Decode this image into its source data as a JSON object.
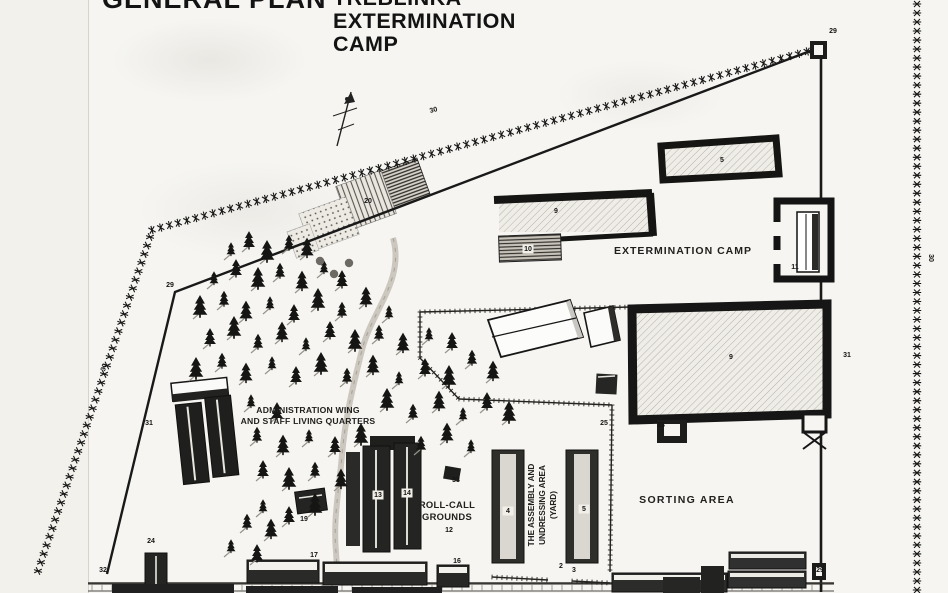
{
  "page": {
    "paper_color": "#f6f5f1",
    "ink_color": "#1a1a1a"
  },
  "titles": {
    "plan": "GENERAL PLAN",
    "camp_line1": "TREBLINKA",
    "camp_line2": "EXTERMINATION",
    "camp_line3": "CAMP"
  },
  "area_labels": [
    {
      "text": "EXTERMINATION CAMP",
      "x": 683,
      "y": 254,
      "size": 10.5,
      "ls": 1
    },
    {
      "text": "ADMINISTRATION WING",
      "x": 308,
      "y": 413,
      "size": 8.6,
      "ls": 0.2
    },
    {
      "text": "AND STAFF LIVING QUARTERS",
      "x": 308,
      "y": 424,
      "size": 8.6,
      "ls": 0.2
    },
    {
      "text": "ROLL-CALL",
      "x": 447,
      "y": 508,
      "size": 9.4,
      "ls": 0.3
    },
    {
      "text": "GROUNDS",
      "x": 447,
      "y": 520,
      "size": 9.4,
      "ls": 0.3
    },
    {
      "text": "THE ASSEMBLY AND",
      "x": 534,
      "y": 505,
      "size": 8.2,
      "rot": -90
    },
    {
      "text": "UNDRESSING AREA",
      "x": 545,
      "y": 505,
      "size": 8.2,
      "rot": -90
    },
    {
      "text": "(YARD)",
      "x": 556,
      "y": 505,
      "size": 8.2,
      "rot": -90
    },
    {
      "text": "SORTING AREA",
      "x": 687,
      "y": 503,
      "size": 10.5,
      "ls": 1.3
    }
  ],
  "number_labels": [
    {
      "t": "29",
      "x": 833,
      "y": 33
    },
    {
      "t": "30",
      "x": 434,
      "y": 112,
      "rot": -15
    },
    {
      "t": "30",
      "x": 929,
      "y": 258,
      "rot": 90
    },
    {
      "t": "30",
      "x": 106,
      "y": 368,
      "rot": -72
    },
    {
      "t": "29",
      "x": 170,
      "y": 287
    },
    {
      "t": "31",
      "x": 149,
      "y": 425
    },
    {
      "t": "31",
      "x": 847,
      "y": 357
    },
    {
      "t": "32",
      "x": 103,
      "y": 572
    },
    {
      "t": "24",
      "x": 151,
      "y": 543
    },
    {
      "t": "19",
      "x": 304,
      "y": 521
    },
    {
      "t": "20",
      "x": 368,
      "y": 203
    },
    {
      "t": "13",
      "x": 378,
      "y": 497,
      "bg": true
    },
    {
      "t": "14",
      "x": 407,
      "y": 495,
      "bg": true
    },
    {
      "t": "12",
      "x": 449,
      "y": 532
    },
    {
      "t": "33",
      "x": 456,
      "y": 482
    },
    {
      "t": "4",
      "x": 508,
      "y": 513,
      "bg": true
    },
    {
      "t": "5",
      "x": 584,
      "y": 511,
      "bg": true
    },
    {
      "t": "9",
      "x": 556,
      "y": 213
    },
    {
      "t": "10",
      "x": 528,
      "y": 251,
      "bg": true
    },
    {
      "t": "5",
      "x": 722,
      "y": 162
    },
    {
      "t": "11",
      "x": 795,
      "y": 269
    },
    {
      "t": "25",
      "x": 604,
      "y": 425
    },
    {
      "t": "33",
      "x": 661,
      "y": 427
    },
    {
      "t": "9",
      "x": 731,
      "y": 359
    },
    {
      "t": "29",
      "x": 820,
      "y": 572
    },
    {
      "t": "2",
      "x": 561,
      "y": 568
    },
    {
      "t": "3",
      "x": 574,
      "y": 572
    },
    {
      "t": "17",
      "x": 314,
      "y": 557
    },
    {
      "t": "16",
      "x": 457,
      "y": 563
    }
  ],
  "icons": [
    "north-arrow-icon",
    "fence-barb-icon",
    "tree-icon",
    "watchtower-icon"
  ],
  "trees": [
    [
      231,
      252
    ],
    [
      249,
      244
    ],
    [
      267,
      256
    ],
    [
      289,
      246
    ],
    [
      307,
      252
    ],
    [
      214,
      281
    ],
    [
      236,
      272
    ],
    [
      258,
      283
    ],
    [
      280,
      274
    ],
    [
      302,
      285
    ],
    [
      324,
      270
    ],
    [
      342,
      283
    ],
    [
      200,
      311
    ],
    [
      224,
      302
    ],
    [
      246,
      315
    ],
    [
      270,
      306
    ],
    [
      294,
      317
    ],
    [
      318,
      304
    ],
    [
      342,
      313
    ],
    [
      366,
      301
    ],
    [
      389,
      315
    ],
    [
      210,
      341
    ],
    [
      234,
      332
    ],
    [
      258,
      345
    ],
    [
      282,
      336
    ],
    [
      306,
      347
    ],
    [
      330,
      334
    ],
    [
      355,
      345
    ],
    [
      379,
      336
    ],
    [
      403,
      347
    ],
    [
      429,
      337
    ],
    [
      452,
      345
    ],
    [
      196,
      373
    ],
    [
      222,
      364
    ],
    [
      246,
      377
    ],
    [
      272,
      366
    ],
    [
      296,
      379
    ],
    [
      321,
      368
    ],
    [
      347,
      379
    ],
    [
      373,
      369
    ],
    [
      399,
      381
    ],
    [
      425,
      371
    ],
    [
      449,
      381
    ],
    [
      472,
      361
    ],
    [
      493,
      375
    ],
    [
      251,
      404
    ],
    [
      277,
      415
    ],
    [
      387,
      404
    ],
    [
      413,
      415
    ],
    [
      439,
      405
    ],
    [
      463,
      417
    ],
    [
      487,
      405
    ],
    [
      509,
      417
    ],
    [
      257,
      438
    ],
    [
      283,
      449
    ],
    [
      309,
      439
    ],
    [
      335,
      449
    ],
    [
      361,
      439
    ],
    [
      421,
      447
    ],
    [
      447,
      437
    ],
    [
      471,
      449
    ],
    [
      263,
      473
    ],
    [
      289,
      483
    ],
    [
      315,
      473
    ],
    [
      341,
      483
    ],
    [
      263,
      509
    ],
    [
      289,
      519
    ],
    [
      315,
      509
    ],
    [
      247,
      525
    ],
    [
      271,
      533
    ],
    [
      231,
      549
    ],
    [
      257,
      557
    ]
  ],
  "bushes": [
    [
      320,
      261
    ],
    [
      334,
      274
    ],
    [
      349,
      263
    ]
  ]
}
